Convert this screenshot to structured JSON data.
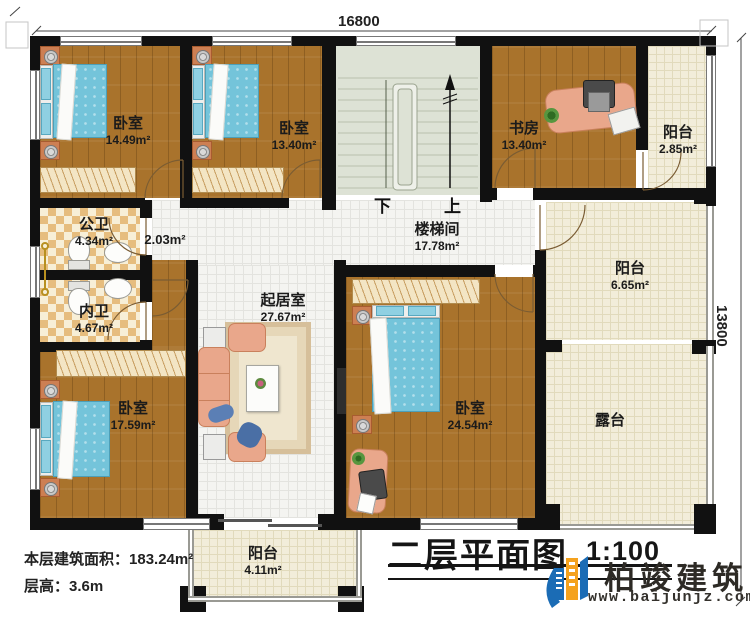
{
  "plan": {
    "dim_width": "16800",
    "dim_height": "13800",
    "stair_down": "下",
    "stair_up": "上",
    "rooms": {
      "bedroom_tl": {
        "name": "卧室",
        "area": "14.49m²"
      },
      "bedroom_t2": {
        "name": "卧室",
        "area": "13.40m²"
      },
      "study": {
        "name": "书房",
        "area": "13.40m²"
      },
      "balcony_tr": {
        "name": "阳台",
        "area": "2.85m²"
      },
      "stairwell": {
        "name": "楼梯间",
        "area": "17.78m²"
      },
      "hall": {
        "area": "2.03m²"
      },
      "public_bath": {
        "name": "公卫",
        "area": "4.34m²"
      },
      "private_bath": {
        "name": "内卫",
        "area": "4.67m²"
      },
      "balcony_right": {
        "name": "阳台",
        "area": "6.65m²"
      },
      "living": {
        "name": "起居室",
        "area": "27.67m²"
      },
      "bedroom_bl": {
        "name": "卧室",
        "area": "17.59m²"
      },
      "bedroom_bc": {
        "name": "卧室",
        "area": "24.54m²"
      },
      "terrace": {
        "name": "露台"
      },
      "balcony_bottom": {
        "name": "阳台",
        "area": "4.11m²"
      }
    }
  },
  "info": {
    "floor_area_label": "本层建筑面积：",
    "floor_area_value": "183.24m²",
    "floor_height_label": "层高：",
    "floor_height_value": "3.6m"
  },
  "titleblock": {
    "title": "二层平面图",
    "scale": "1:100",
    "company": "柏竣建筑",
    "website": "www.baijunjz.com"
  },
  "colors": {
    "wall": "#111111",
    "wood_floor": "#a9732c",
    "white_tile": "#f4f4f1",
    "cream_tile": "#f2edda",
    "stair_floor": "#dde2d5",
    "bed_blue": "#74c4da",
    "bath_checker": "#e6bd7e",
    "logo_blue": "#1b6cb5",
    "logo_orange": "#f5a21d"
  }
}
